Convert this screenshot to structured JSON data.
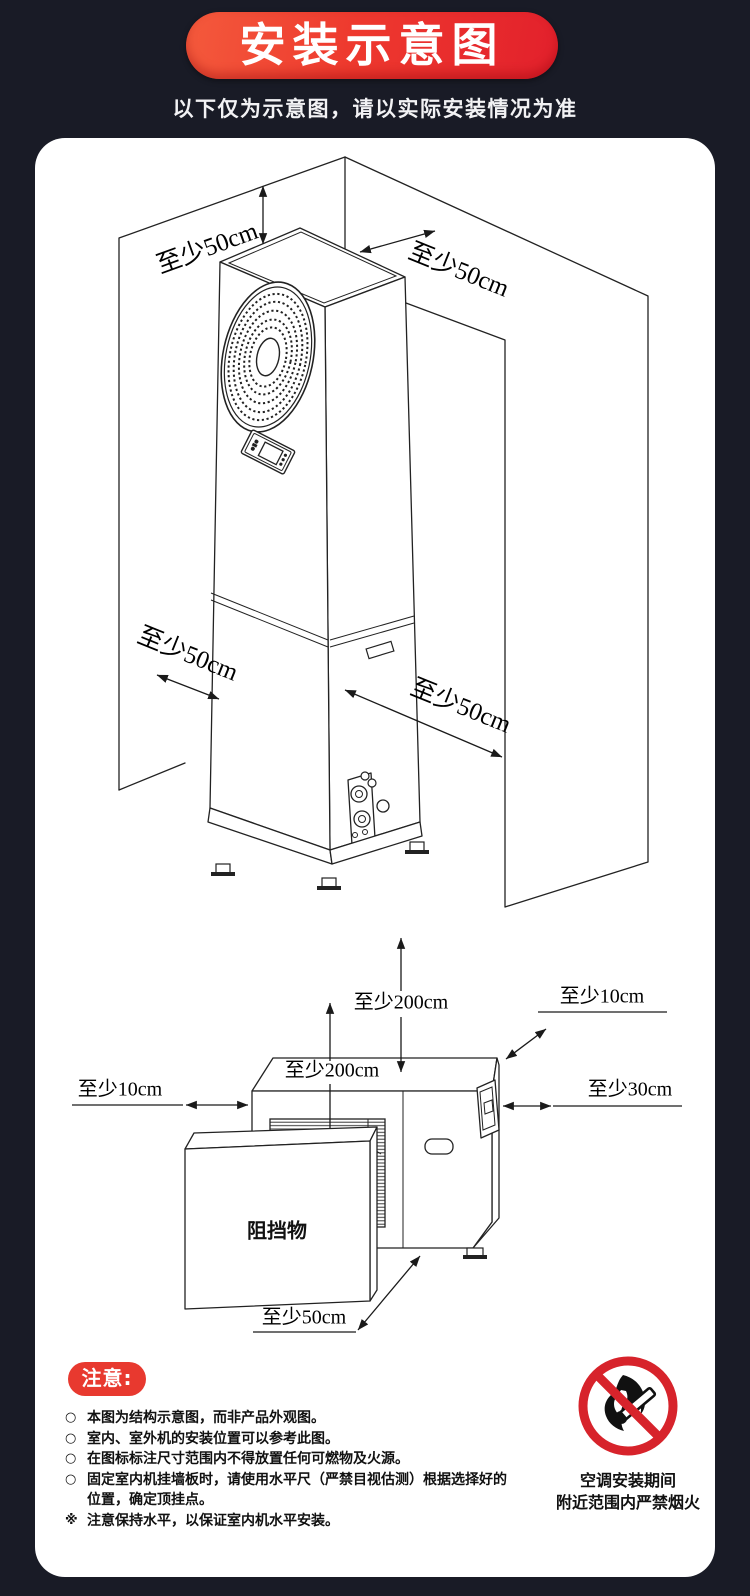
{
  "banner": {
    "title": "安装示意图",
    "subtitle": "以下仅为示意图，请以实际安装情况为准"
  },
  "indoor_diagram": {
    "clearance_top": "至少50cm",
    "clearance_back": "至少50cm",
    "clearance_left": "至少50cm",
    "clearance_right": "至少50cm"
  },
  "outdoor_diagram": {
    "clearance_above": "至少200cm",
    "clearance_top_surface": "至少200cm",
    "clearance_back_corner": "至少10cm",
    "clearance_left": "至少10cm",
    "clearance_right": "至少30cm",
    "clearance_front": "至少50cm",
    "obstruction_label": "阻挡物"
  },
  "notice": {
    "title": "注意:",
    "items": [
      {
        "marker": "○",
        "text": "本图为结构示意图，而非产品外观图。"
      },
      {
        "marker": "○",
        "text": "室内、室外机的安装位置可以参考此图。"
      },
      {
        "marker": "○",
        "text": "在图标标注尺寸范围内不得放置任何可燃物及火源。"
      },
      {
        "marker": "○",
        "text": "固定室内机挂墙板时，请使用水平尺（严禁目视估测）根据选择好的位置，确定顶挂点。"
      },
      {
        "marker": "※",
        "text": "注意保持水平，以保证室内机水平安装。"
      }
    ]
  },
  "fire_warning": {
    "line1": "空调安装期间",
    "line2": "附近范围内严禁烟火"
  },
  "colors": {
    "background": "#191b26",
    "banner_gradient_start": "#f45a3c",
    "banner_gradient_end": "#e2202c",
    "notice_red": "#e8392f",
    "prohibition_red": "#d7232b",
    "line_color": "#222222"
  }
}
